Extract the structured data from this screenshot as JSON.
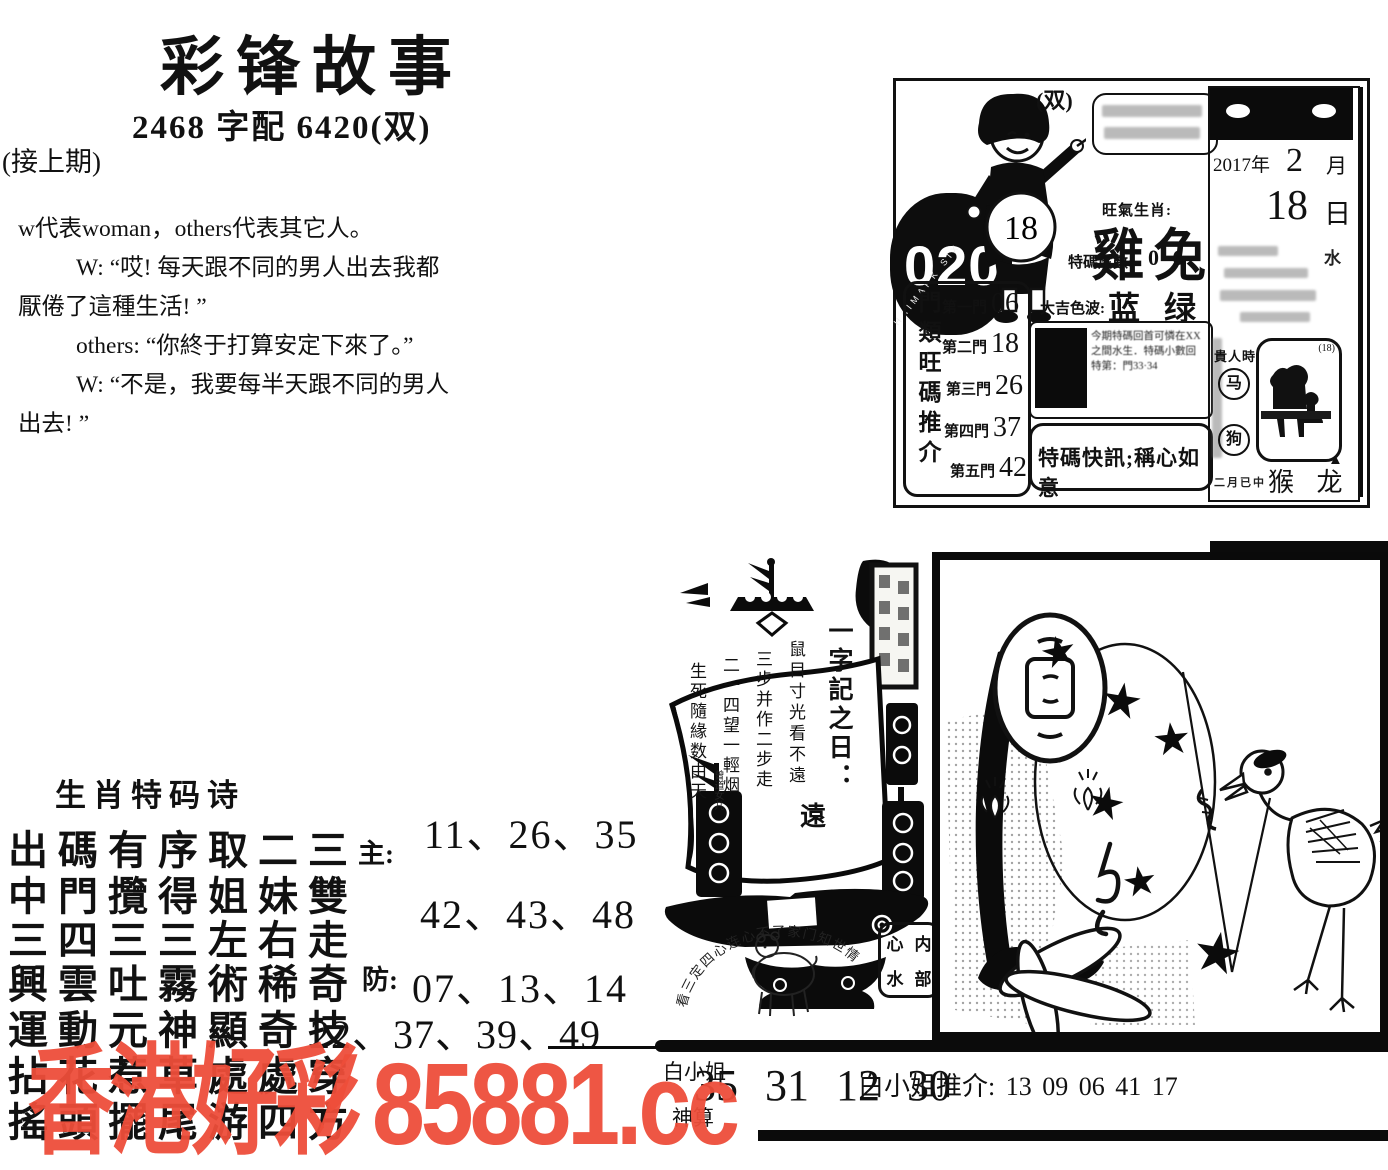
{
  "page": {
    "bg": "#ffffff",
    "ink": "#111111",
    "watermark_color": "#ee4e3a"
  },
  "header": {
    "title": "彩锋故事",
    "subtitle": "2468 字配 6420(双)",
    "continued": "(接上期)"
  },
  "story": {
    "intro": "w代表woman，others代表其它人。",
    "line1": "W: “哎! 每天跟不同的男人出去我都",
    "line2": "厭倦了這種生活! ”",
    "line3": "others: “你終于打算安定下來了。”",
    "line4": "W: “不是，我要每半天跟不同的男人",
    "line5": "出去! ”"
  },
  "calendar": {
    "issue": "020",
    "ring_text": "HAIMARK SIX",
    "double_mark": "(双)",
    "boy_number": "18",
    "zodiac_label": "旺氣生肖:",
    "zodiac_glyphs": "雞兔",
    "tail_label": "特碼尾數:",
    "tail_value": "0 6",
    "color_label": "大吉色波:",
    "color_value": "蓝 绿",
    "note1": "今期特碼回首可憐在XX",
    "note2": "之間水生．特碼小數回",
    "note3": "特第：門33·34",
    "special_bulletin": "特碼快訊;稱心如意",
    "doors_title": "門類旺碼推介",
    "doors": [
      {
        "label": "第一門",
        "value": "06"
      },
      {
        "label": "第二門",
        "value": "18"
      },
      {
        "label": "第三門",
        "value": "26"
      },
      {
        "label": "第四門",
        "value": "37"
      },
      {
        "label": "第五門",
        "value": "42"
      }
    ],
    "date_year": "2017年",
    "date_month": "2",
    "date_month_unit": "月",
    "date_day": "18",
    "date_day_unit": "日",
    "page_small_char": "水",
    "noble_label": "貴人時",
    "noble_1": "马",
    "noble_2": "狗",
    "box_corner": "(18)",
    "foot_small": "二月已中",
    "foot_zodiac": "猴 龙"
  },
  "ship": {
    "sail_title": "一字記之日：",
    "sail_big_char": "遠",
    "col1": "鼠目寸光看不遠",
    "col2": "三步并作二步走",
    "col3": "二一四望一輕烟",
    "col4": "生死隨緣数由天",
    "signature": "曾道女儿",
    "arc_text": "看三定四心连心不了家门知世情",
    "stamp_r1c1": "心",
    "stamp_r1c2": "内",
    "stamp_r2c1": "水",
    "stamp_r2c2": "部"
  },
  "poem": {
    "title": "生肖特码诗",
    "line1": "出碼有序取二三",
    "line2": "中門攬得姐妹雙",
    "line3": "三四三三左右走",
    "line4": "興雲吐霧術稀奇",
    "line5": "運動元神顯奇技",
    "line6": "拈花惹草處處穿",
    "line7": "搖頭擺尾游四方",
    "main_label": "主:",
    "main_row1": "11、26、35",
    "main_row2": "42、43、48",
    "guard_label": "防:",
    "guard_row1": "07、13、14",
    "guard_row2": "22、37、39、49"
  },
  "bottom": {
    "left_top": "白小姐",
    "left_bottom": "神算",
    "numbers": "35 31 12 30",
    "recommend": "白小姐推介: 13 09 06 41 17"
  },
  "watermark": {
    "site_cn": "香港好彩",
    "separator": "/",
    "site_url": "85881.cc"
  },
  "picture": {
    "star": "★",
    "triangle": "▲"
  }
}
